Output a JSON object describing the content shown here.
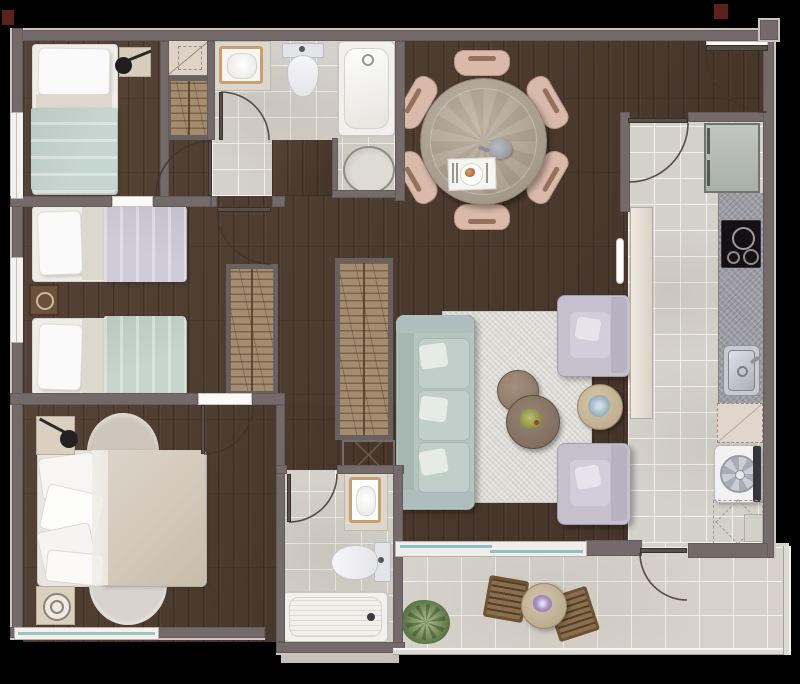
{
  "meta": {
    "type": "residential floor plan, top-down rendered view",
    "canvas": {
      "width_px": 800,
      "height_px": 684,
      "background": "black"
    },
    "text_visible": "none"
  },
  "palette": {
    "wall": "#756a6a",
    "structural_column": "#5c211d",
    "wood_floor": "#4c392c",
    "tile_floor": "#d4d1ca",
    "counter_granite": "#9c9ba4",
    "mint_fabric": "#c7d5d0",
    "lavender_fabric": "#d0cbd9",
    "beige_duvet": "#d3c9bb",
    "dining_chair": "#d9b9a9",
    "rug": "#dcdad5",
    "wardrobe_wood": "#a68c6e",
    "glass": "#9ec4c1",
    "balcony_wood": "#8a6f4e"
  },
  "rooms": [
    {
      "id": "bedroom-1",
      "position": "top-left",
      "furniture": [
        "single-bed-mint",
        "nightstand",
        "table-lamp",
        "shelf-cabinet",
        "wardrobe"
      ],
      "window": "left wall"
    },
    {
      "id": "bathroom-1",
      "position": "top-center",
      "furniture": [
        "vanity-sink",
        "toilet",
        "bathtub",
        "round-shower"
      ],
      "door": "swing"
    },
    {
      "id": "bedroom-2",
      "position": "middle-left",
      "furniture": [
        "single-bed-lavender",
        "single-bed-mint",
        "nightstand",
        "wardrobe"
      ],
      "window": "left wall"
    },
    {
      "id": "master-bedroom",
      "position": "bottom-left",
      "furniture": [
        "double-bed",
        "nightstand-top",
        "nightstand-bottom",
        "desk-lamp",
        "half-round-rug-top",
        "half-round-rug-bottom"
      ],
      "window": "bottom wall"
    },
    {
      "id": "hallway",
      "position": "center",
      "furniture": [
        "wardrobe",
        "service-cabinet-x"
      ]
    },
    {
      "id": "living-dining",
      "position": "center-right",
      "furniture": [
        "round-dining-table",
        "dining-chairs",
        "teapot",
        "place-setting",
        "sofa-3-seat",
        "armchair-top",
        "armchair-bottom",
        "coffee-table-large",
        "coffee-table-small",
        "side-table",
        "area-rug",
        "plant-pot"
      ]
    },
    {
      "id": "kitchen",
      "position": "right",
      "furniture": [
        "refrigerator",
        "cooktop-4-burner",
        "granite-counter",
        "stainless-sink",
        "appliance-space-dashed",
        "washing-machine",
        "peninsula-counter"
      ],
      "door": "swing"
    },
    {
      "id": "bathroom-2",
      "position": "bottom-center",
      "furniture": [
        "vanity-sink",
        "toilet",
        "bathtub"
      ],
      "door": "swing"
    },
    {
      "id": "balcony",
      "position": "bottom-right",
      "furniture": [
        "bistro-table",
        "wood-chair-left",
        "wood-chair-right",
        "potted-plant",
        "purple-flower"
      ],
      "access": [
        "sliding-glass-door",
        "swing-door-from-kitchen"
      ]
    }
  ],
  "counts": {
    "bedrooms": 3,
    "bathrooms": 2,
    "dining_chairs": 6,
    "armchairs": 2,
    "balcony_chairs": 2,
    "doors_swing": 8,
    "windows": 3,
    "structural_columns": 2
  }
}
